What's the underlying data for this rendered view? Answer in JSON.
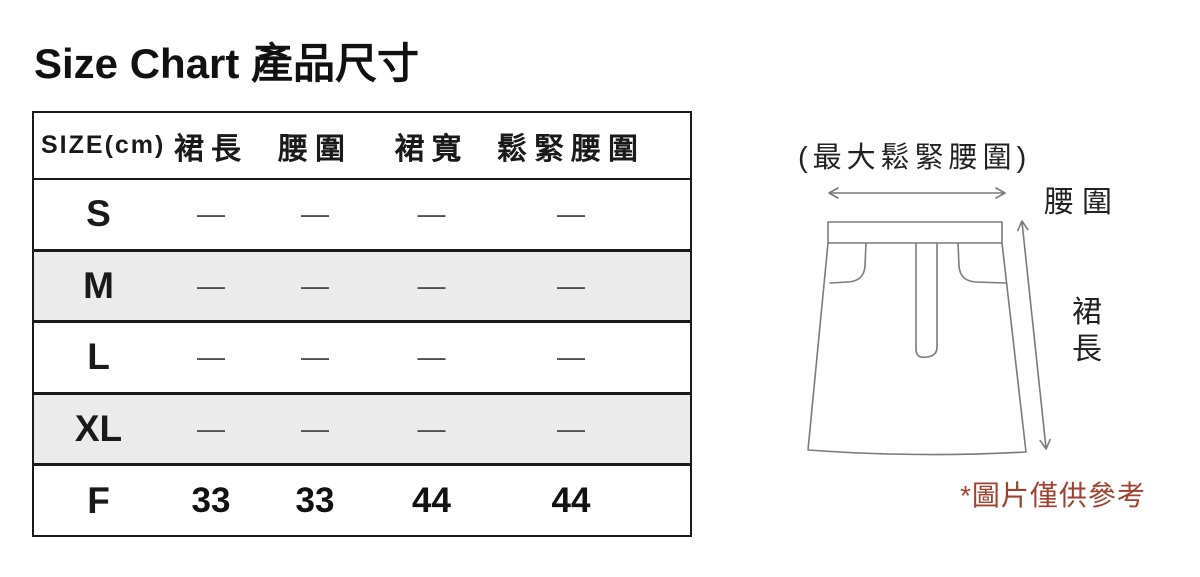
{
  "title": "Size Chart 產品尺寸",
  "table": {
    "headers": [
      "SIZE(cm)",
      "裙長",
      "腰圍",
      "裙寬",
      "鬆緊腰圍"
    ],
    "rows": [
      {
        "size": "S",
        "values": [
          "—",
          "—",
          "—",
          "—"
        ]
      },
      {
        "size": "M",
        "values": [
          "—",
          "—",
          "—",
          "—"
        ]
      },
      {
        "size": "L",
        "values": [
          "—",
          "—",
          "—",
          "—"
        ]
      },
      {
        "size": "XL",
        "values": [
          "—",
          "—",
          "—",
          "—"
        ]
      },
      {
        "size": "F",
        "values": [
          "33",
          "33",
          "44",
          "44"
        ]
      }
    ]
  },
  "diagram": {
    "top_label": "(最大鬆緊腰圍)",
    "waist_label": "腰圍",
    "length_label": "裙長",
    "note": "*圖片僅供參考"
  },
  "colors": {
    "border": "#1A1A1A",
    "row_alt_bg": "#EBEBEB",
    "dash": "#4F4F4F",
    "sketch_line": "#7B7B7B",
    "note_red": "#A04130"
  }
}
